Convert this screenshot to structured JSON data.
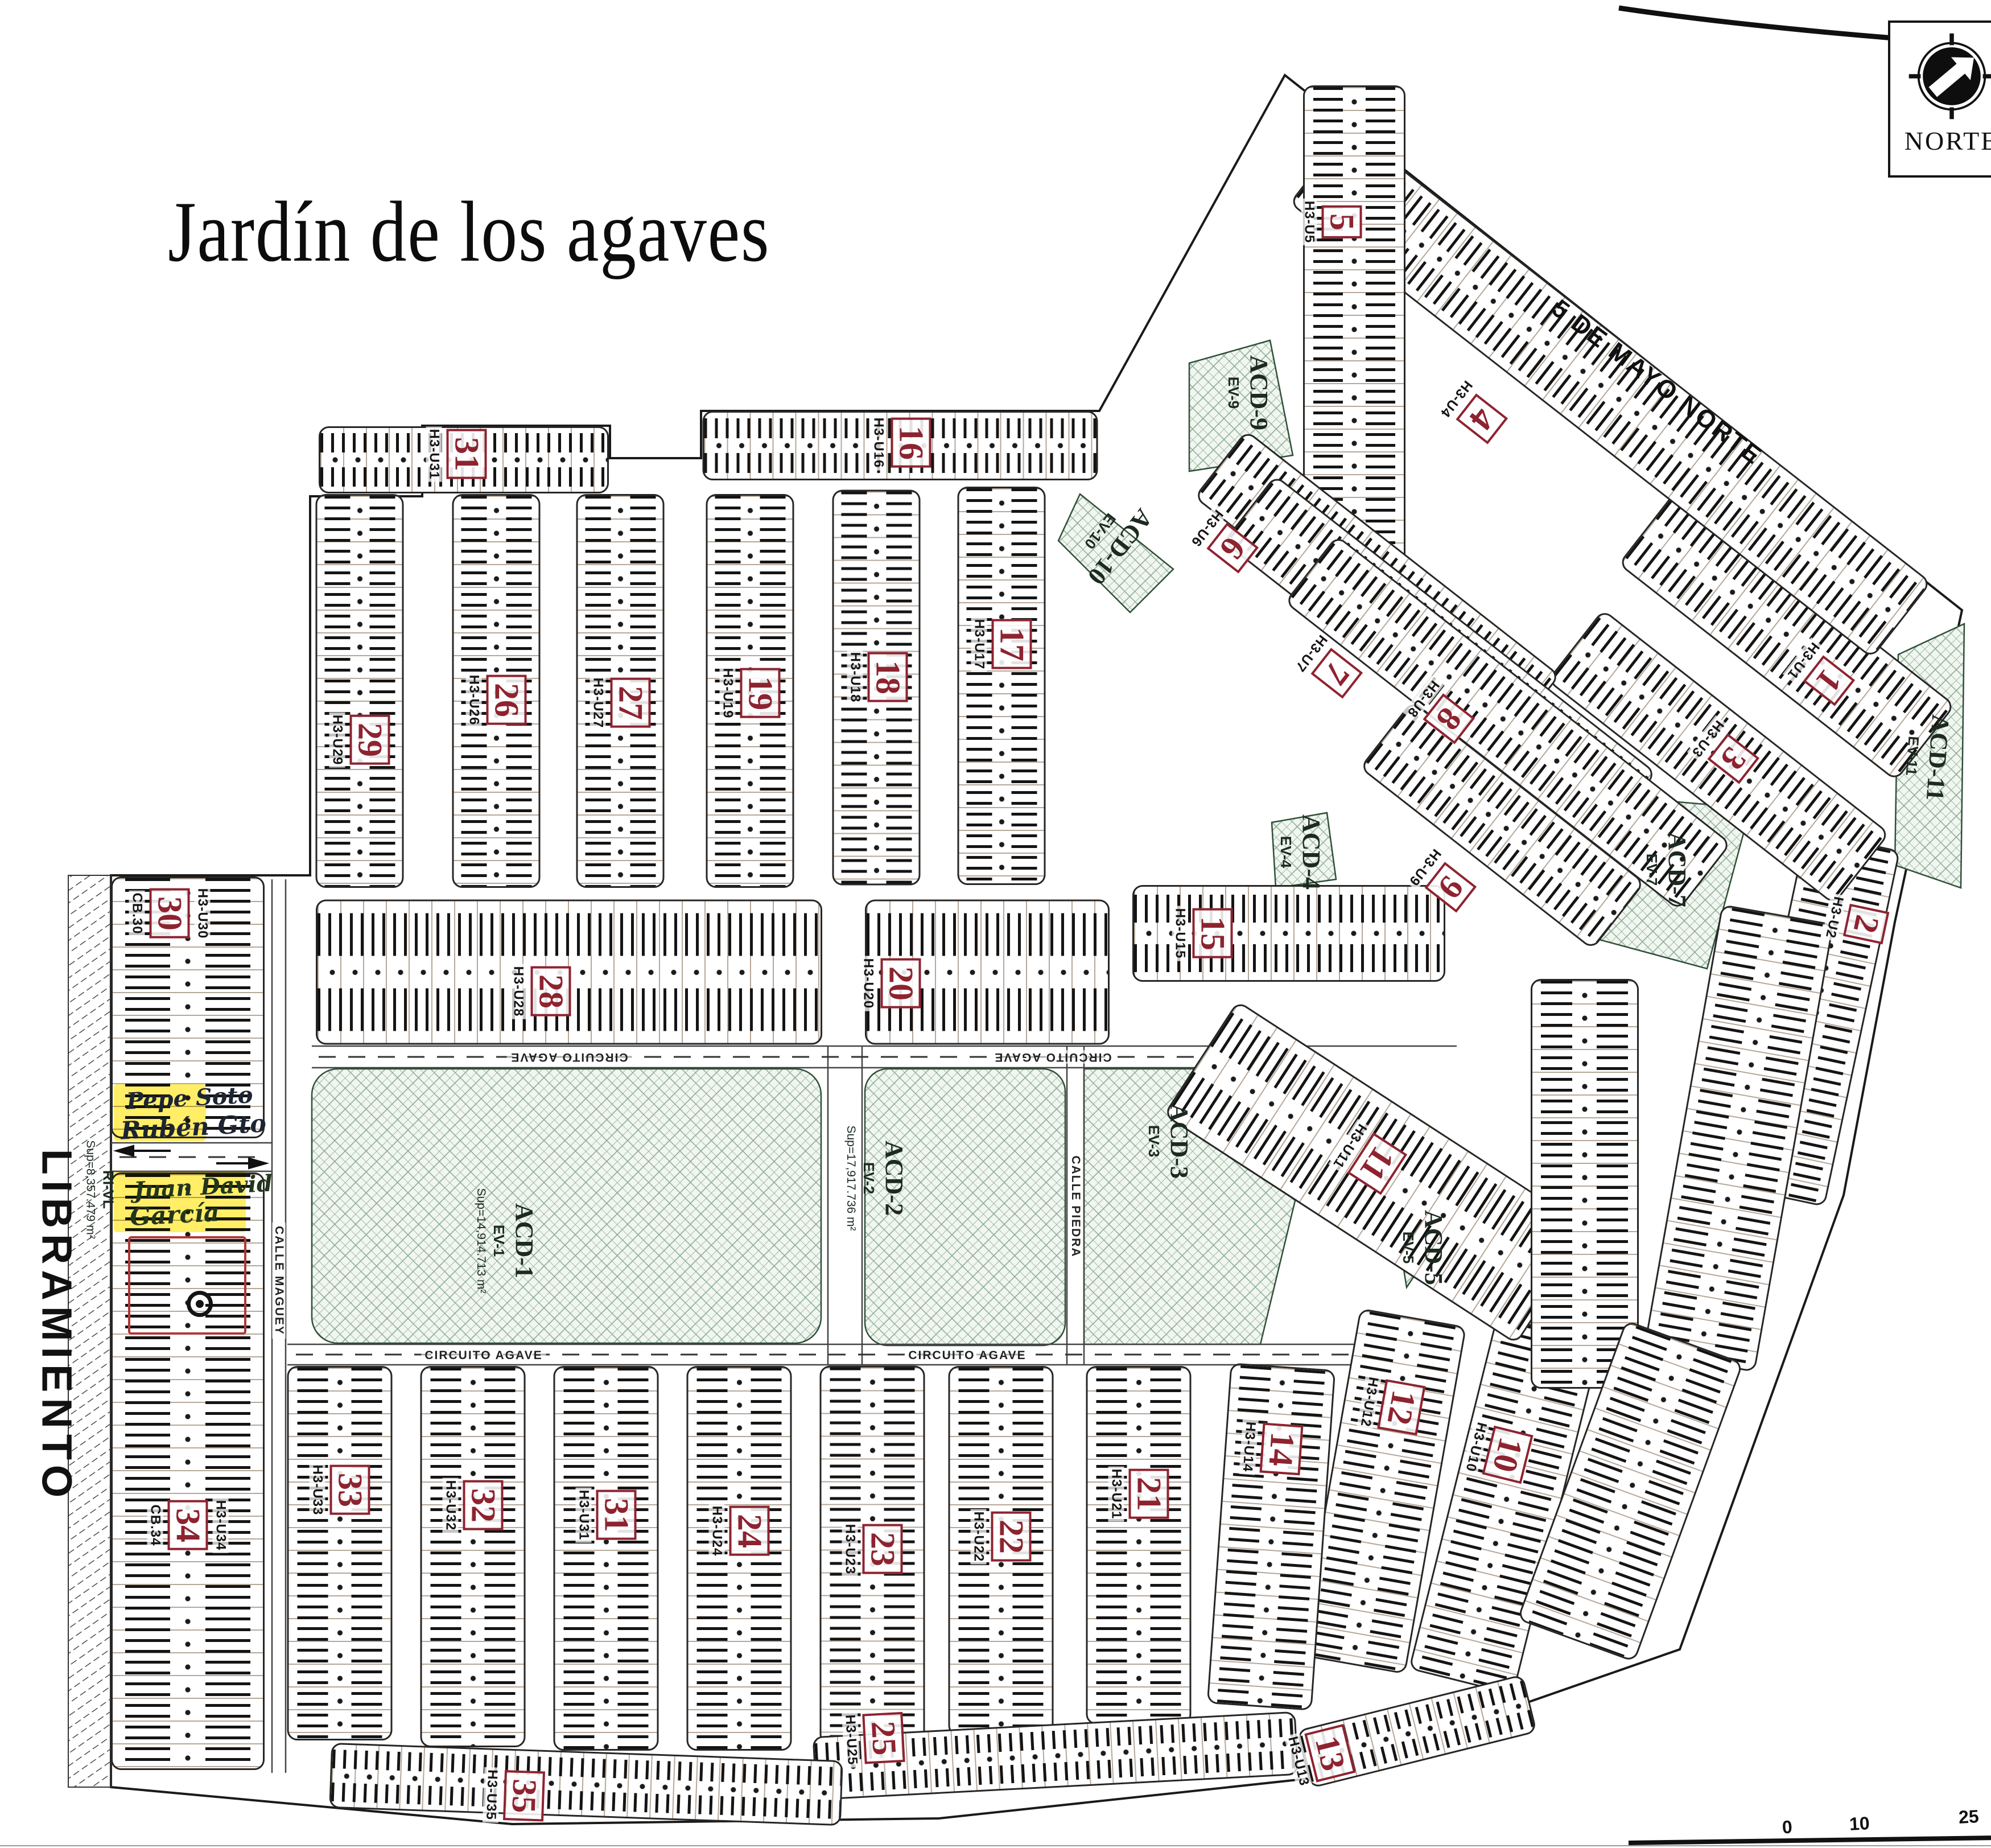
{
  "title": "Jardín de los agaves",
  "north": {
    "label": "NORTE"
  },
  "roads": {
    "libramiento": "LIBRAMIENTO",
    "cinco_de_mayo": "5 DE MAYO NORTE",
    "ri_vl": "RI-VL",
    "ri_vl_sup": "Sup=8,357.479 m²",
    "circuito_agave": "CIRCUITO AGAVE",
    "calle_piedra": "CALLE PIEDRA",
    "calle_maguey": "CALLE MAGUEY"
  },
  "scale_bar": {
    "tick_0": "0",
    "tick_10": "10",
    "tick_25": "25"
  },
  "annotations": {
    "highlight_a_line1": "Pepe Soto",
    "highlight_a_line2": "Rubén Gto",
    "highlight_b_line1": "Juan David",
    "highlight_b_line2": "García"
  },
  "green_areas": [
    {
      "id": "acd1",
      "name": "ACD-1",
      "ev": "EV-1",
      "sup": "Sup=14,914.713 m²"
    },
    {
      "id": "acd2",
      "name": "ACD-2",
      "ev": "EV-2",
      "sup": "Sup=17,917.736 m²"
    },
    {
      "id": "acd3",
      "name": "ACD-3",
      "ev": "EV-3",
      "sup": ""
    },
    {
      "id": "acd4",
      "name": "ACD-4",
      "ev": "EV-4",
      "sup": ""
    },
    {
      "id": "acd5",
      "name": "ACD-5",
      "ev": "EV-5",
      "sup": ""
    },
    {
      "id": "acd7",
      "name": "ACD-7",
      "ev": "EV-7",
      "sup": ""
    },
    {
      "id": "acd9",
      "name": "ACD-9",
      "ev": "EV-9",
      "sup": ""
    },
    {
      "id": "acd10",
      "name": "ACD-10",
      "ev": "EV-10",
      "sup": ""
    },
    {
      "id": "acd11",
      "name": "ACD-11",
      "ev": "EV-11",
      "sup": ""
    }
  ],
  "blocks": [
    {
      "num": "1",
      "code": "H3-U1"
    },
    {
      "num": "2",
      "code": "H3-U2"
    },
    {
      "num": "3",
      "code": "H3-U3"
    },
    {
      "num": "4",
      "code": "H3-U4"
    },
    {
      "num": "5",
      "code": "H3-U5"
    },
    {
      "num": "6",
      "code": "H3-U6"
    },
    {
      "num": "7",
      "code": "H3-U7"
    },
    {
      "num": "8",
      "code": "H3-U8"
    },
    {
      "num": "9",
      "code": "H3-U9"
    },
    {
      "num": "10",
      "code": "H3-U10"
    },
    {
      "num": "11",
      "code": "H3-U11"
    },
    {
      "num": "12",
      "code": "H3-U12"
    },
    {
      "num": "13",
      "code": "H3-U13"
    },
    {
      "num": "14",
      "code": "H3-U14"
    },
    {
      "num": "15",
      "code": "H3-U15"
    },
    {
      "num": "16",
      "code": "H3-U16"
    },
    {
      "num": "17",
      "code": "H3-U17"
    },
    {
      "num": "18",
      "code": "H3-U18"
    },
    {
      "num": "19",
      "code": "H3-U19"
    },
    {
      "num": "20",
      "code": "H3-U20"
    },
    {
      "num": "21",
      "code": "H3-U21"
    },
    {
      "num": "22",
      "code": "H3-U22"
    },
    {
      "num": "23",
      "code": "H3-U23"
    },
    {
      "num": "24",
      "code": "H3-U24"
    },
    {
      "num": "25",
      "code": "H3-U25"
    },
    {
      "num": "26",
      "code": "H3-U26"
    },
    {
      "num": "27",
      "code": "H3-U27"
    },
    {
      "num": "28",
      "code": "H3-U28"
    },
    {
      "num": "29",
      "code": "H3-U29"
    },
    {
      "num": "30",
      "code": "H3-U30",
      "extra": "CB.30"
    },
    {
      "num": "31",
      "code": "H3-U31"
    },
    {
      "num": "31",
      "code": "H3-U31"
    },
    {
      "num": "32",
      "code": "H3-U32"
    },
    {
      "num": "33",
      "code": "H3-U33"
    },
    {
      "num": "34",
      "code": "H3-U34",
      "extra": "CB.34"
    },
    {
      "num": "35",
      "code": "H3-U35"
    }
  ]
}
